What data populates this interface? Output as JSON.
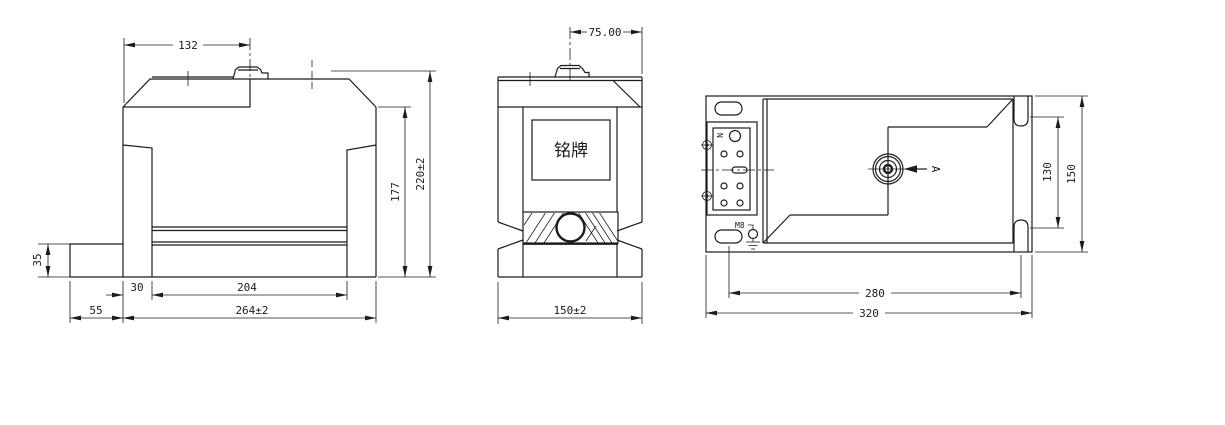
{
  "drawing_type": "engineering-three-view-technical-drawing",
  "front": {
    "dim_132": "132",
    "dim_35": "35",
    "dim_30": "30",
    "dim_204": "204",
    "dim_55": "55",
    "dim_264": "264±2",
    "dim_177": "177",
    "dim_220": "220±2"
  },
  "side": {
    "dim_75": "75.00",
    "dim_150": "150±2",
    "nameplate": "铭牌"
  },
  "top": {
    "dim_280": "280",
    "dim_320": "320",
    "dim_130": "130",
    "dim_150": "150",
    "label_n": "N",
    "label_m8": "M8",
    "label_a": "A"
  },
  "colors": {
    "line": "#1c1c1c",
    "background": "#ffffff"
  }
}
